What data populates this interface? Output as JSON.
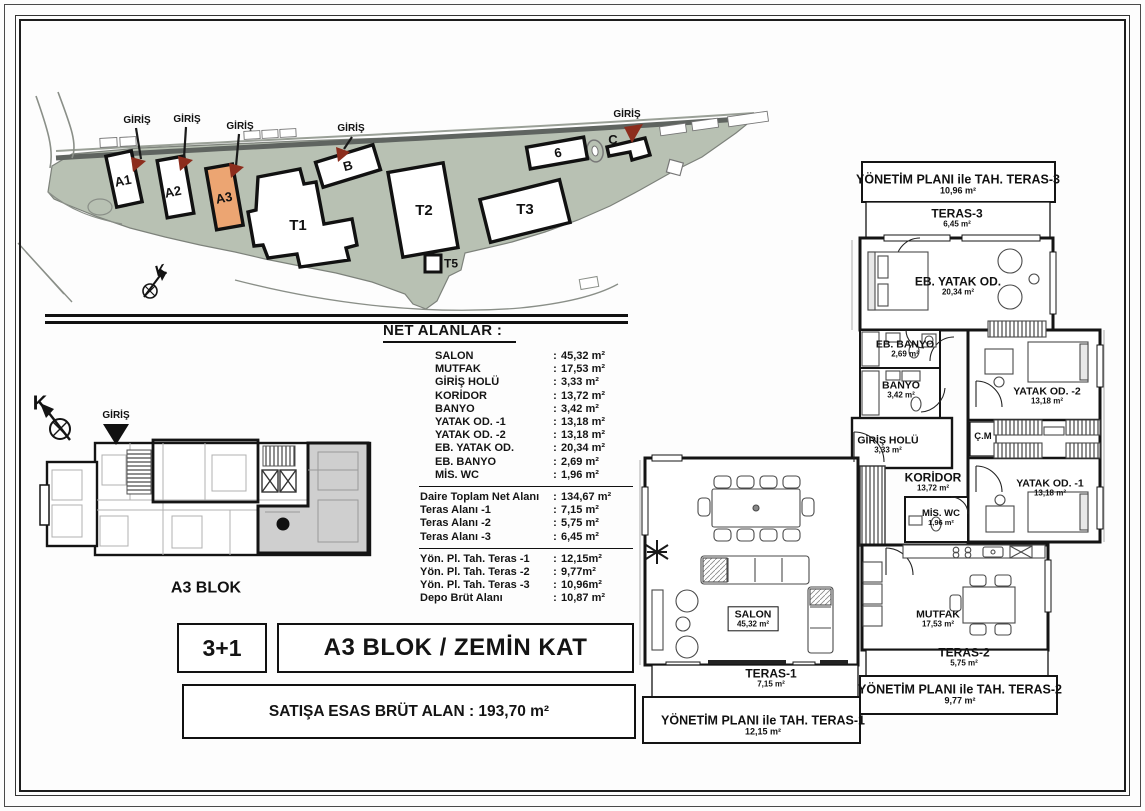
{
  "document": {
    "type_label": "floor-plan-sheet",
    "colors": {
      "highlight_building": "#eca572",
      "site_ground": "#b8c1b3",
      "entrance_arrow": "#8c2d1d"
    }
  },
  "title_block": {
    "unit_type": "3+1",
    "title": "A3 BLOK / ZEMİN KAT",
    "gross_area": "SATIŞA ESAS BRÜT ALAN : 193,70 m²"
  },
  "net_table": {
    "heading": "NET ALANLAR :",
    "separator": ":",
    "groups": [
      {
        "rows": [
          {
            "label": "SALON",
            "value": "45,32 m²"
          },
          {
            "label": "MUTFAK",
            "value": "17,53 m²"
          },
          {
            "label": "GİRİŞ HOLÜ",
            "value": "3,33 m²"
          },
          {
            "label": "KORİDOR",
            "value": "13,72 m²"
          },
          {
            "label": "BANYO",
            "value": "3,42 m²"
          },
          {
            "label": "YATAK OD. -1",
            "value": "13,18 m²"
          },
          {
            "label": "YATAK OD. -2",
            "value": "13,18 m²"
          },
          {
            "label": "EB. YATAK OD.",
            "value": "20,34 m²"
          },
          {
            "label": "EB. BANYO",
            "value": "2,69 m²"
          },
          {
            "label": "MİS. WC",
            "value": "1,96 m²"
          }
        ]
      },
      {
        "rows": [
          {
            "label": "Daire Toplam Net Alanı",
            "value": "134,67 m²"
          },
          {
            "label": "Teras Alanı -1",
            "value": "7,15 m²"
          },
          {
            "label": "Teras Alanı -2",
            "value": "5,75 m²"
          },
          {
            "label": "Teras Alanı -3",
            "value": "6,45 m²"
          }
        ]
      },
      {
        "rows": [
          {
            "label": "Yön. Pl. Tah. Teras -1",
            "value": "12,15m²"
          },
          {
            "label": "Yön. Pl. Tah. Teras  -2",
            "value": "9,77m²"
          },
          {
            "label": "Yön. Pl. Tah. Teras  -3",
            "value": "10,96m²"
          },
          {
            "label": "Depo Brüt Alanı",
            "value": "10,87 m²"
          }
        ]
      }
    ]
  },
  "site_plan": {
    "entrance_label": "GİRİŞ",
    "north_label": "K",
    "buildings": [
      {
        "id": "A1"
      },
      {
        "id": "A2"
      },
      {
        "id": "A3"
      },
      {
        "id": "B"
      },
      {
        "id": "T1"
      },
      {
        "id": "T2"
      },
      {
        "id": "T3"
      },
      {
        "id": "T5"
      },
      {
        "id": "C"
      },
      {
        "id": "6"
      }
    ]
  },
  "key_plan": {
    "name": "A3 BLOK",
    "entrance_label": "GİRİŞ",
    "north_label": "K"
  },
  "floor_plan": {
    "rooms": [
      {
        "name": "YÖNETİM PLANI ile TAH. TERAS-3",
        "area": "10,96 m²"
      },
      {
        "name": "TERAS-3",
        "area": "6,45 m²"
      },
      {
        "name": "EB. YATAK OD.",
        "area": "20,34 m²"
      },
      {
        "name": "EB. BANYO",
        "area": "2,69 m²"
      },
      {
        "name": "BANYO",
        "area": "3,42 m²"
      },
      {
        "name": "YATAK OD. -2",
        "area": "13,18 m²"
      },
      {
        "name": "GİRİŞ HOLÜ",
        "area": "3,33 m²"
      },
      {
        "name": "Ç.M",
        "area": ""
      },
      {
        "name": "KORİDOR",
        "area": "13,72 m²"
      },
      {
        "name": "YATAK OD. -1",
        "area": "13,18 m²"
      },
      {
        "name": "MİS. WC",
        "area": "1,96 m²"
      },
      {
        "name": "SALON",
        "area": "45,32 m²"
      },
      {
        "name": "MUTFAK",
        "area": "17,53 m²"
      },
      {
        "name": "TERAS-1",
        "area": "7,15 m²"
      },
      {
        "name": "YÖNETİM PLANI ile TAH. TERAS-1",
        "area": "12,15 m²"
      },
      {
        "name": "TERAS-2",
        "area": "5,75 m²"
      },
      {
        "name": "YÖNETİM PLANI ile TAH. TERAS-2",
        "area": "9,77 m²"
      }
    ]
  }
}
